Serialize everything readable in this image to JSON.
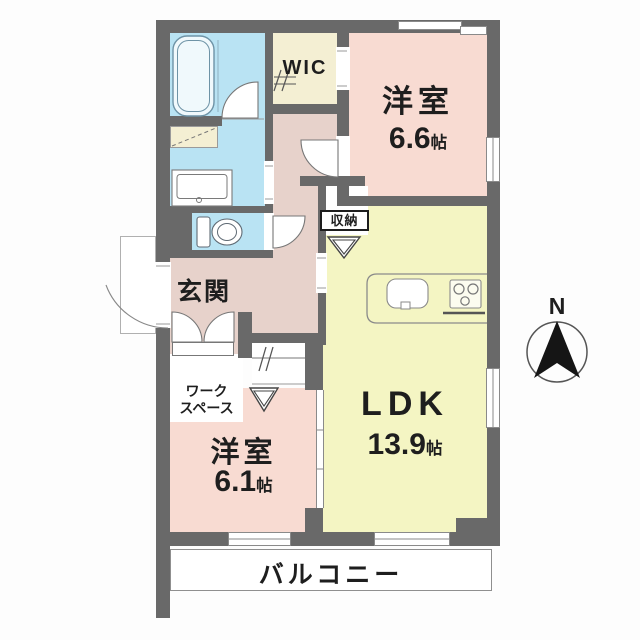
{
  "rooms": {
    "bedroom_main": {
      "label": "洋室",
      "size": "6.6",
      "unit": "帖"
    },
    "bedroom_sub": {
      "label": "洋室",
      "size": "6.1",
      "unit": "帖"
    },
    "ldk": {
      "label": "LDK",
      "size": "13.9",
      "unit": "帖"
    },
    "wic": {
      "label": "WIC"
    },
    "entrance": {
      "label": "玄関"
    },
    "storage": {
      "label": "収納"
    },
    "workspace": {
      "line1": "ワーク",
      "line2": "スペース"
    },
    "balcony": {
      "label": "バルコニー"
    }
  },
  "compass": {
    "label": "N"
  },
  "colors": {
    "wall": "#696969",
    "water_room": "#b9e3f3",
    "bedroom": "#f8dbd2",
    "hall": "#e7d2cb",
    "ldk": "#f4f5c3",
    "closet_cream": "#f4efd3",
    "line": "#8a8a8a"
  }
}
